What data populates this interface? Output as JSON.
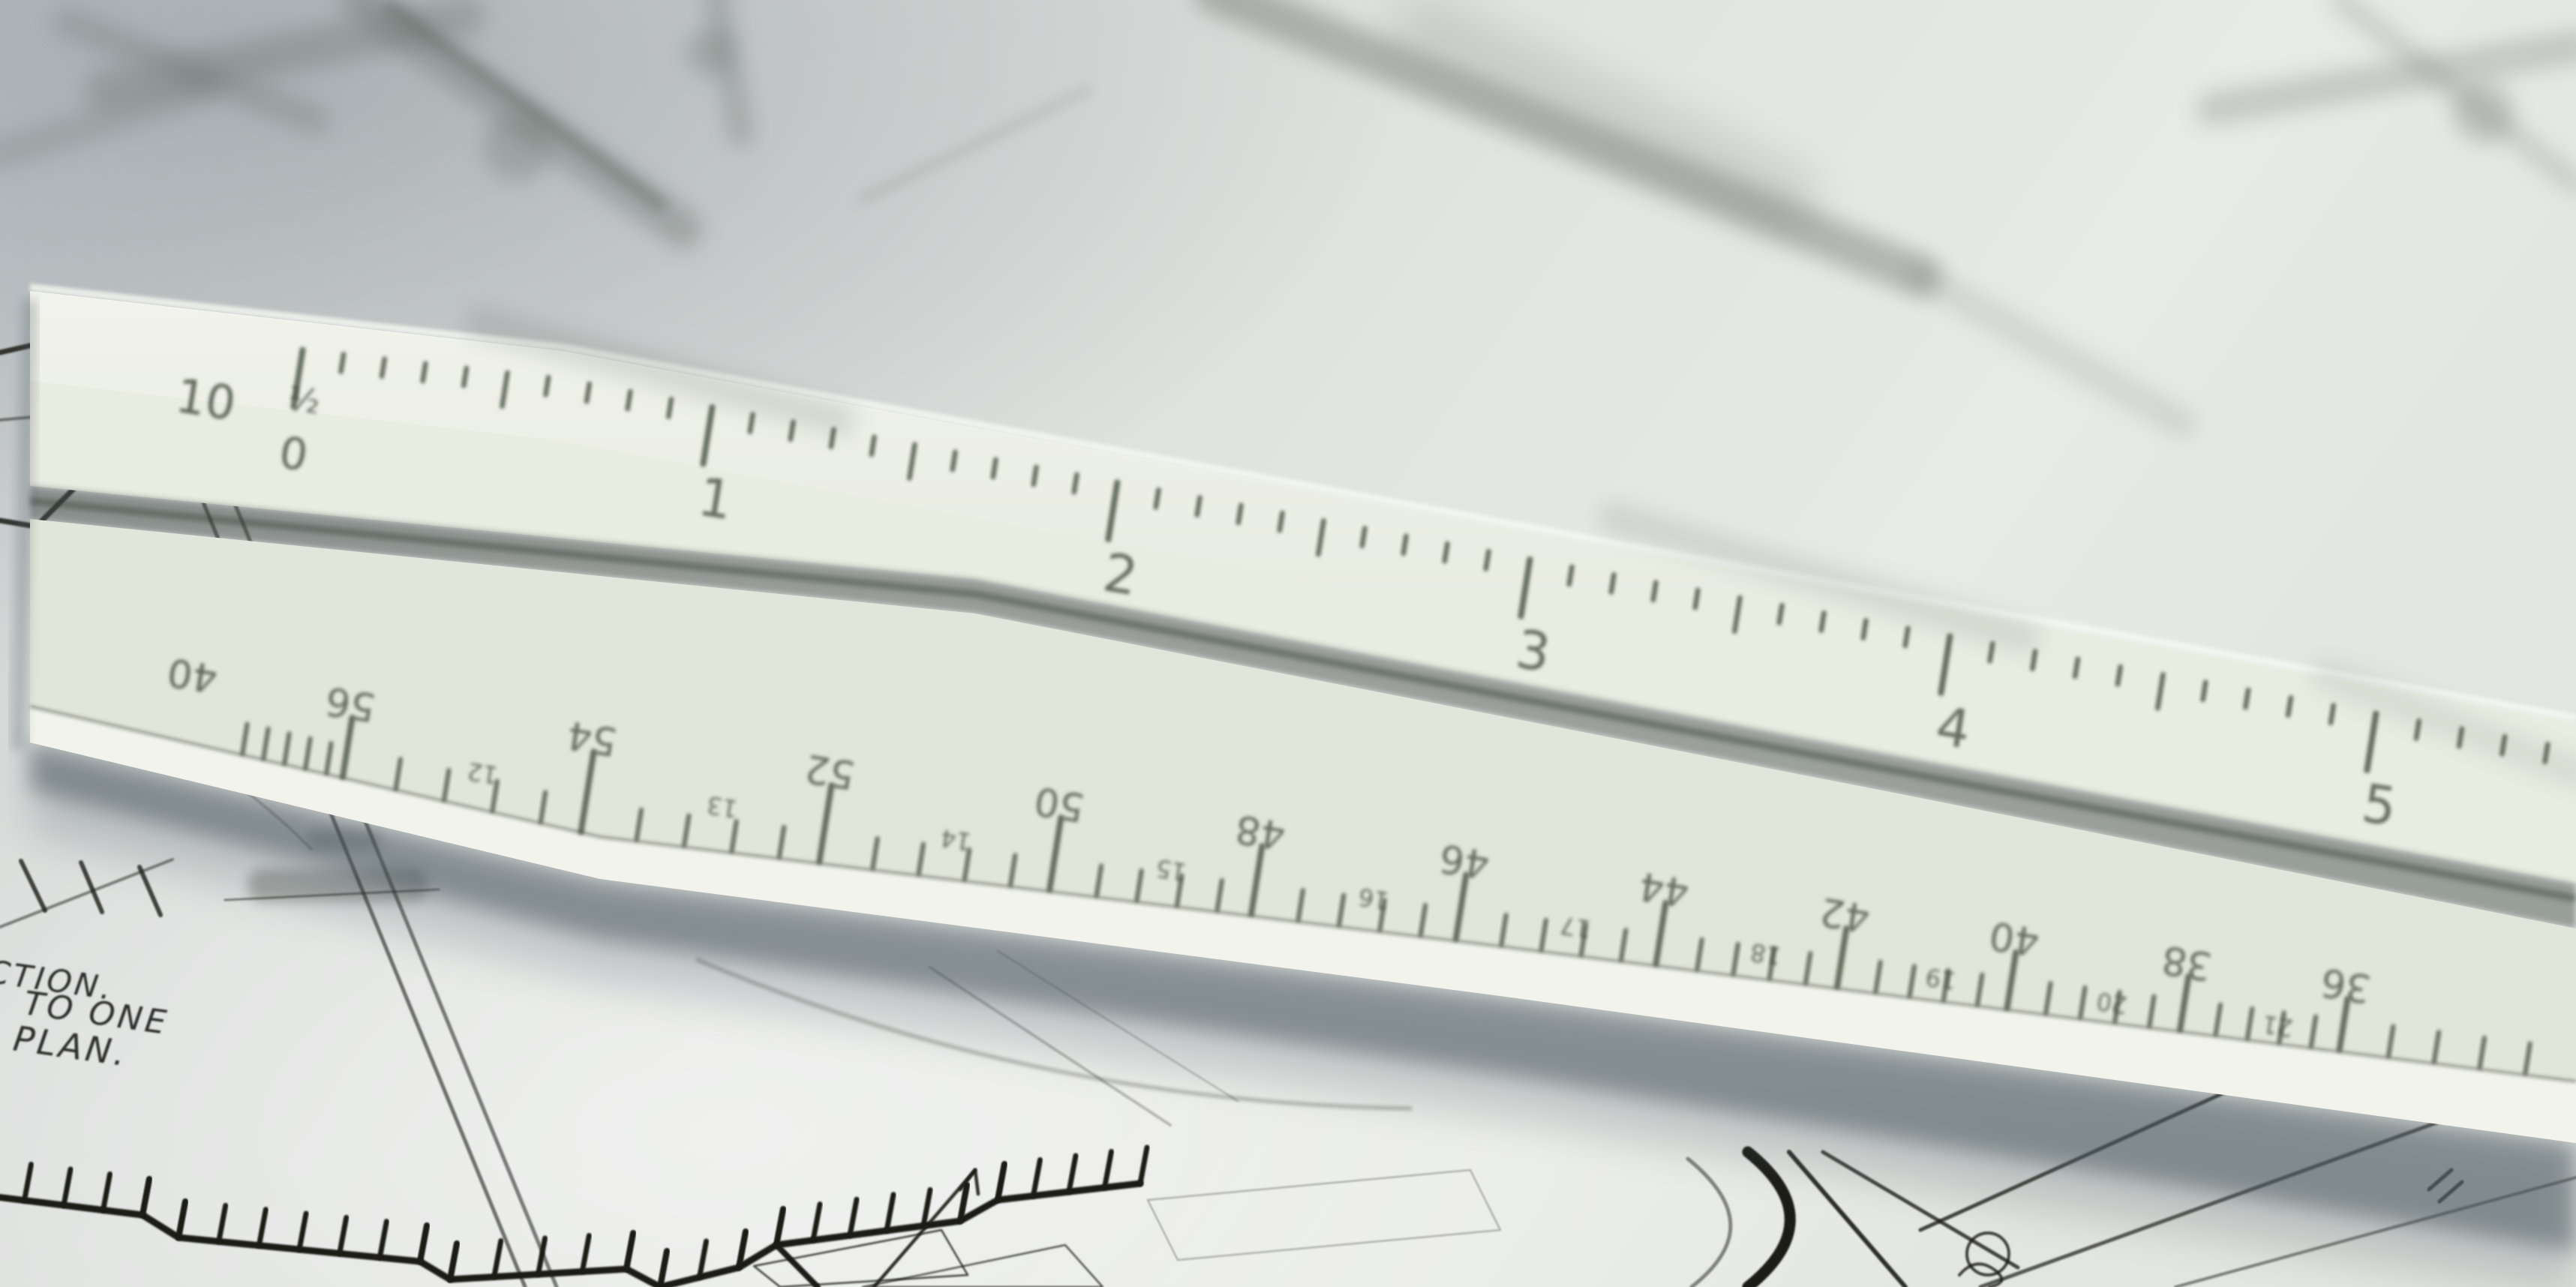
{
  "ruler": {
    "top_scale": {
      "label": "10",
      "zero": "0",
      "half_mark": "½",
      "numbers": [
        "1",
        "2",
        "3",
        "4",
        "5"
      ]
    },
    "bottom_scale": {
      "label": "40",
      "major_numbers": [
        "56",
        "54",
        "52",
        "50",
        "48",
        "46",
        "44",
        "42",
        "40",
        "38",
        "36"
      ],
      "minor_numbers": [
        "12",
        "13",
        "14",
        "15",
        "16",
        "17",
        "18",
        "19",
        "20",
        "21"
      ]
    }
  },
  "drawing_text": {
    "lines": [
      "CTION.",
      "TO ONE",
      "PLAN."
    ]
  },
  "colors": {
    "paper": "#e0e2df",
    "ruler_face_top": "#e9ece1",
    "ruler_face_bottom": "#e2e6da",
    "ruler_bevel": "#f2f4eb",
    "groove": "#3f4a44",
    "marking": "#46503f",
    "ink": "#1a1a17",
    "note_ink": "#2e2e2a",
    "shadow": "#45525a",
    "smudge": "#5c655f"
  }
}
